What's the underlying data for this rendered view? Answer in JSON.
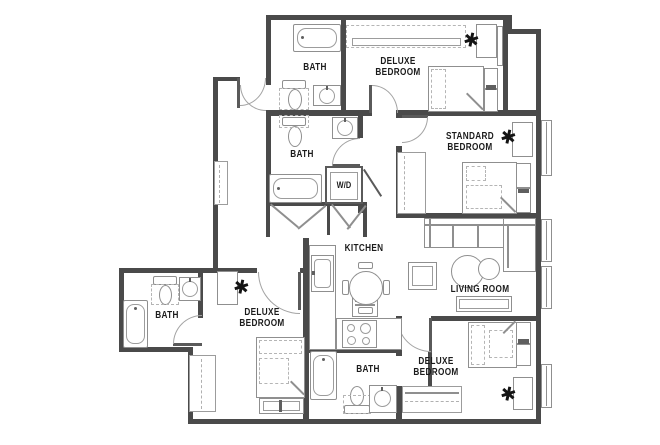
{
  "rooms": {
    "bath_top": {
      "label": "BATH"
    },
    "deluxe_bedroom_top": {
      "line1": "DELUXE",
      "line2": "BEDROOM"
    },
    "standard_bedroom": {
      "line1": "STANDARD",
      "line2": "BEDROOM"
    },
    "bath_middle": {
      "label": "BATH"
    },
    "laundry": {
      "label": "W/D"
    },
    "kitchen": {
      "label": "KITCHEN"
    },
    "living_room": {
      "label": "LIVING ROOM"
    },
    "bath_left": {
      "label": "BATH"
    },
    "deluxe_bedroom_left": {
      "line1": "DELUXE",
      "line2": "BEDROOM"
    },
    "bath_bottom": {
      "label": "BATH"
    },
    "deluxe_bedroom_bottom": {
      "line1": "DELUXE",
      "line2": "BEDROOM"
    }
  },
  "icons": {
    "desk_chair_glyph": "✱"
  },
  "colors": {
    "wall": "#4a4a4a",
    "furniture_line": "#8f8f8f",
    "label_text": "#1b1b1b"
  }
}
